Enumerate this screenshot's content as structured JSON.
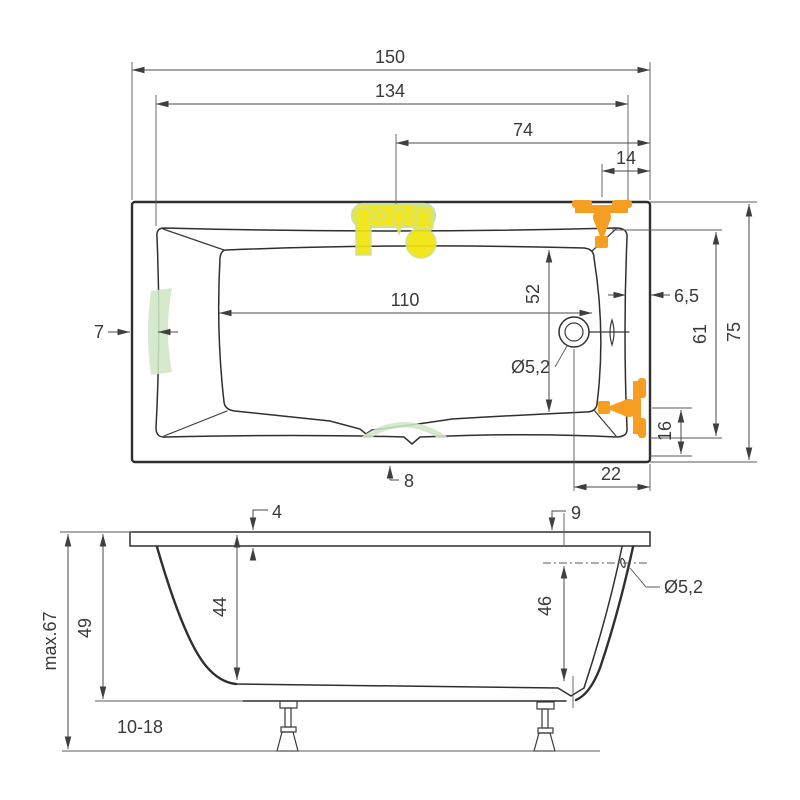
{
  "page": {
    "type": "bathtub technical dimension drawing",
    "background": "#ffffff",
    "units": "cm"
  },
  "colors": {
    "object_line": "#2f2f2f",
    "dimension_line": "#4a4a4a",
    "text": "#3a3a3a",
    "fixture_yellow": "#f1e50c",
    "fixture_yellow_outline": "#c8df92",
    "fixture_orange": "#f59e22",
    "accessory_green": "#cfe6c6",
    "background": "#ffffff"
  },
  "icons": {
    "deck_mixer": "deck-mounted-mixer-icon",
    "rim_faucet": "rim-mounted-faucet-icon",
    "side_faucet": "side-mounted-faucet-icon",
    "headrest": "headrest-pad-icon",
    "grab_handle": "grab-handle-icon",
    "drain": "drain-outlet-icon",
    "overflow": "overflow-slot-icon"
  },
  "top_view": {
    "overall_length": "150",
    "deck_length": "134",
    "mixer_to_edge": "74",
    "faucet_to_edge": "14",
    "rim_width_left": "7",
    "basin_length": "110",
    "basin_width_at_drain": "52",
    "rim_width_right": "6,5",
    "drain_diameter": "Ø5,2",
    "inner_rim_width": "61",
    "overall_width": "75",
    "side_faucet_to_edge": "16",
    "drain_to_edge": "22",
    "grip_offset": "8"
  },
  "side_view": {
    "rim_thickness_head": "4",
    "rim_thickness_foot": "9",
    "overflow_diameter": "Ø5,2",
    "overflow_height": "46",
    "inner_depth": "44",
    "shell_height": "49",
    "max_height": "max.67",
    "feet_adjust_range": "10-18"
  }
}
